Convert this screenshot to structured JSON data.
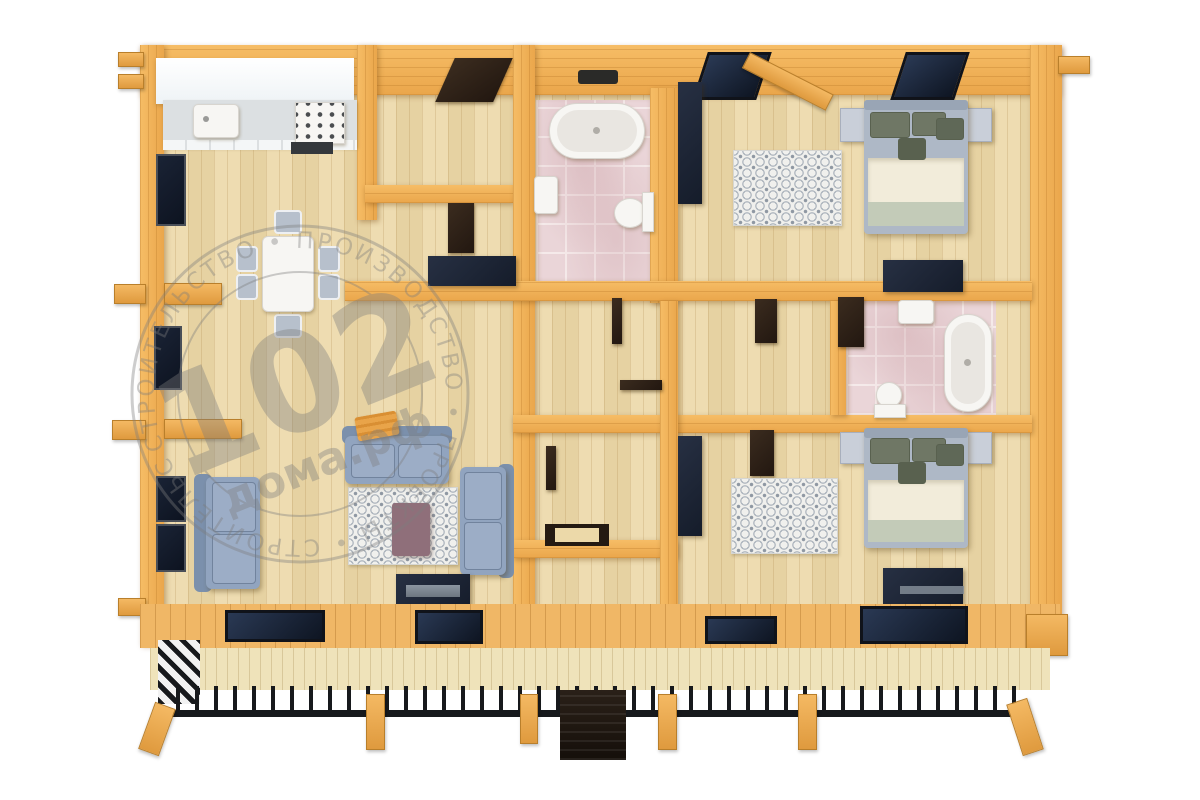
{
  "watermark": {
    "number": "102",
    "domain": "дома.рф",
    "ring_text": "СТРОИТЕЛЬСТВО • ПРОИЗВОДСТВО • ПРОЕКТЫ • СТРОИТЕЛЬСТВО • ПРОИЗВОДСТВО • ПРОЕКТЫ •"
  },
  "palette": {
    "wall_wood": "#f0b25c",
    "floor_wood": "#ecd9a9",
    "tile_pink": "#ead5d8",
    "furniture_dark": "#1f2737",
    "door_brown": "#32261b",
    "sofa_blue": "#91a4bf",
    "bedding_cream": "#f2ecda",
    "blanket_sage": "#c3cbb8",
    "pillow_olive": "#6f7765",
    "coffee_table_mauve": "#8f6f7a",
    "deck_wood": "#f0b766",
    "railing_black": "#17191c",
    "watermark_gray": "#7d7d7d"
  }
}
